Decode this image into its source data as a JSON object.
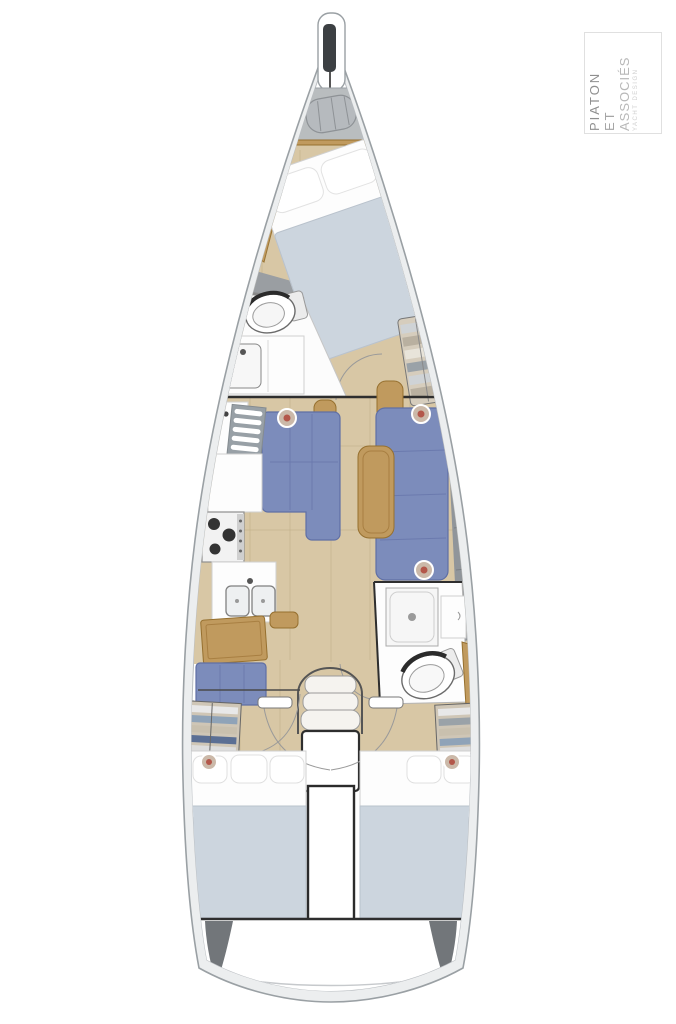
{
  "logo": {
    "line1": "PIATON",
    "line2": "ET",
    "line3": "ASSOCIÉS",
    "tagline": "YACHT DESIGN"
  },
  "colors": {
    "hull_outline": "#9aa0a4",
    "deck_band": "#eceeef",
    "deck_dark": "#72767a",
    "deck_mid": "#90959a",
    "floor_wood": "#d8c7a5",
    "floor_seam": "#bfae88",
    "wood_tan": "#c09a5e",
    "wood_tan_dark": "#96702f",
    "upholstery_blue": "#7c8cbb",
    "upholstery_blue_dark": "#5f6fa5",
    "duvet_blue": "#ccd5de",
    "line_dark": "#2e2e2e",
    "window_blue": "#c9d0d7",
    "bronze": "#c7a873",
    "accent_dot": "#b3574a"
  }
}
